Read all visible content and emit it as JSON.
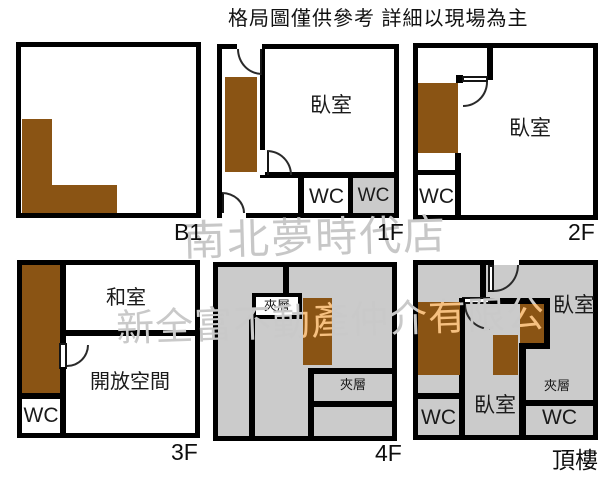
{
  "title": "格局圖僅供參考 詳細以現場為主",
  "watermark": {
    "line1": "南北夢時代店",
    "line2": "新全富不動產仲介有限公"
  },
  "colors": {
    "stair_brown": "#8a5414",
    "mezzanine_gray": "#cbcbcb",
    "wall_black": "#000000",
    "watermark_gray": "#c7c7c7"
  },
  "plans": {
    "b1": {
      "label": "B1"
    },
    "f1": {
      "label": "1F",
      "bedroom": "臥室",
      "wc_left": "WC",
      "wc_right": "WC"
    },
    "f2": {
      "label": "2F",
      "bedroom": "臥室",
      "wc": "WC"
    },
    "f3": {
      "label": "3F",
      "tatami_room": "和室",
      "open_space": "開放空間",
      "wc": "WC"
    },
    "f4": {
      "label": "4F",
      "mezzanine_upper": "夾層",
      "mezzanine_lower": "夾層"
    },
    "roof": {
      "label": "頂樓",
      "bedroom_top": "臥室",
      "bedroom_middle": "臥室",
      "mezzanine": "夾層",
      "wc_left": "WC",
      "wc_right": "WC"
    }
  }
}
